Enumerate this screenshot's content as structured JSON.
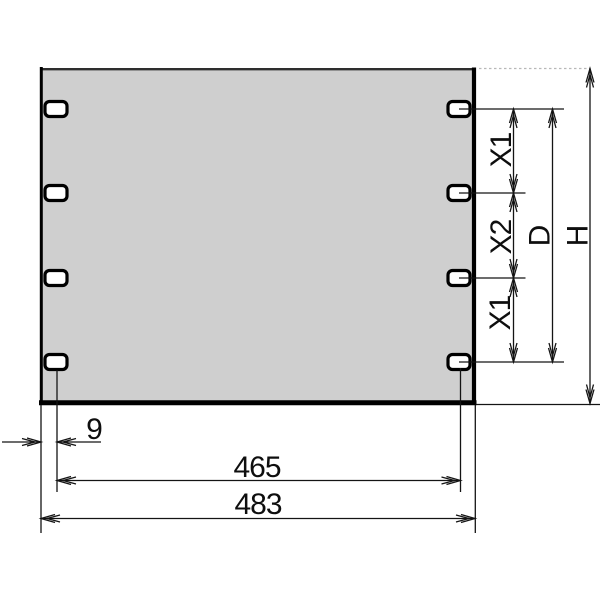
{
  "labels": {
    "x1_top": "X1",
    "x2": "X2",
    "x1_bottom": "X1",
    "d": "D",
    "h": "H",
    "edge_offset": "9",
    "hole_span": "465",
    "overall_width": "483"
  },
  "colors": {
    "background": "#ffffff",
    "panel_fill": "#cfcfcf",
    "hole_fill": "#ffffff",
    "line": "#141414",
    "edge_line": "#000000",
    "hidden_extension_line": "#b8b8b8"
  }
}
